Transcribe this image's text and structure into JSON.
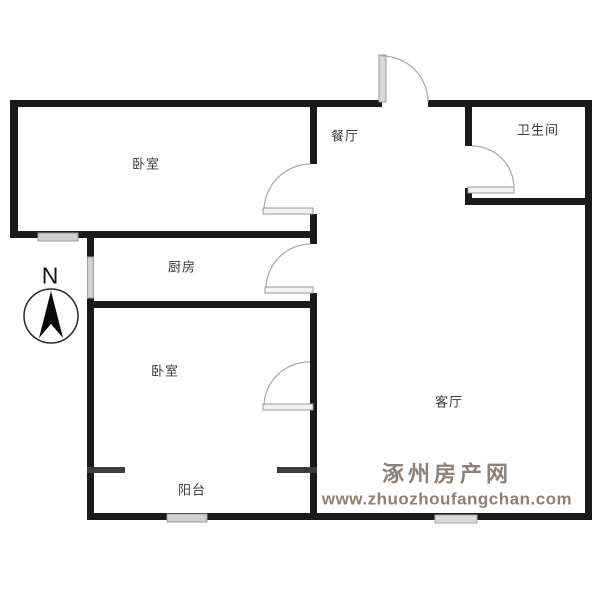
{
  "rooms": {
    "bedroom_top": {
      "label": "卧室"
    },
    "dining": {
      "label": "餐厅"
    },
    "bathroom": {
      "label": "卫生间"
    },
    "kitchen": {
      "label": "厨房"
    },
    "bedroom_bottom": {
      "label": "卧室"
    },
    "living": {
      "label": "客厅"
    },
    "balcony": {
      "label": "阳台"
    }
  },
  "compass": {
    "north_label": "N"
  },
  "watermark": {
    "site_name": "涿州房产网",
    "site_url": "www.zhuozhoufangchan.com"
  },
  "colors": {
    "wall": "#1a1a1a",
    "stub_wall": "#3d3d3d",
    "window_fill": "#cfcfcf",
    "door_line": "#ababab",
    "label_text": "#3a3a3a",
    "watermark_text": "#8a8179",
    "background": "#ffffff"
  }
}
